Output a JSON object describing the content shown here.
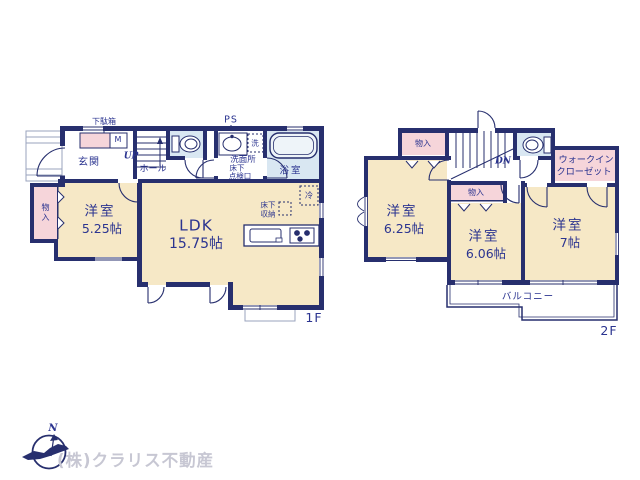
{
  "colors": {
    "wall": "#272f6e",
    "text": "#2b3490",
    "room_fill": "#f6e8c6",
    "closet_fill": "#f6d5da",
    "wet_fill": "#d9e7f2",
    "watermark": "#c7c7d3"
  },
  "floor1": {
    "floor_label": "1F",
    "labels": {
      "getabako": "下駄箱",
      "mirror": "M",
      "genkan": "玄関",
      "up": "UP",
      "hall": "ホール",
      "ps": "PS",
      "washer": "洗",
      "senmenjo": "洗面所",
      "hatch_line1": "床下",
      "hatch_line2": "点検口",
      "bathroom": "浴室",
      "fridge": "冷",
      "floor_storage_line1": "床下",
      "floor_storage_line2": "収納",
      "storage": "物入",
      "bedroom1_name": "洋室",
      "bedroom1_size": "5.25帖",
      "ldk_name": "LDK",
      "ldk_size": "15.75帖"
    }
  },
  "floor2": {
    "floor_label": "2F",
    "labels": {
      "storage_top": "物入",
      "dn": "DN",
      "wic_line1": "ウォークイン",
      "wic_line2": "クローゼット",
      "storage_mid": "物入",
      "bedroom2_name": "洋室",
      "bedroom2_size": "6.25帖",
      "bedroom3_name": "洋室",
      "bedroom3_size": "6.06帖",
      "bedroom4_name": "洋室",
      "bedroom4_size": "7帖",
      "balcony": "バルコニー"
    }
  },
  "footer": {
    "compass_n": "N",
    "company": "(株)クラリス不動産"
  }
}
